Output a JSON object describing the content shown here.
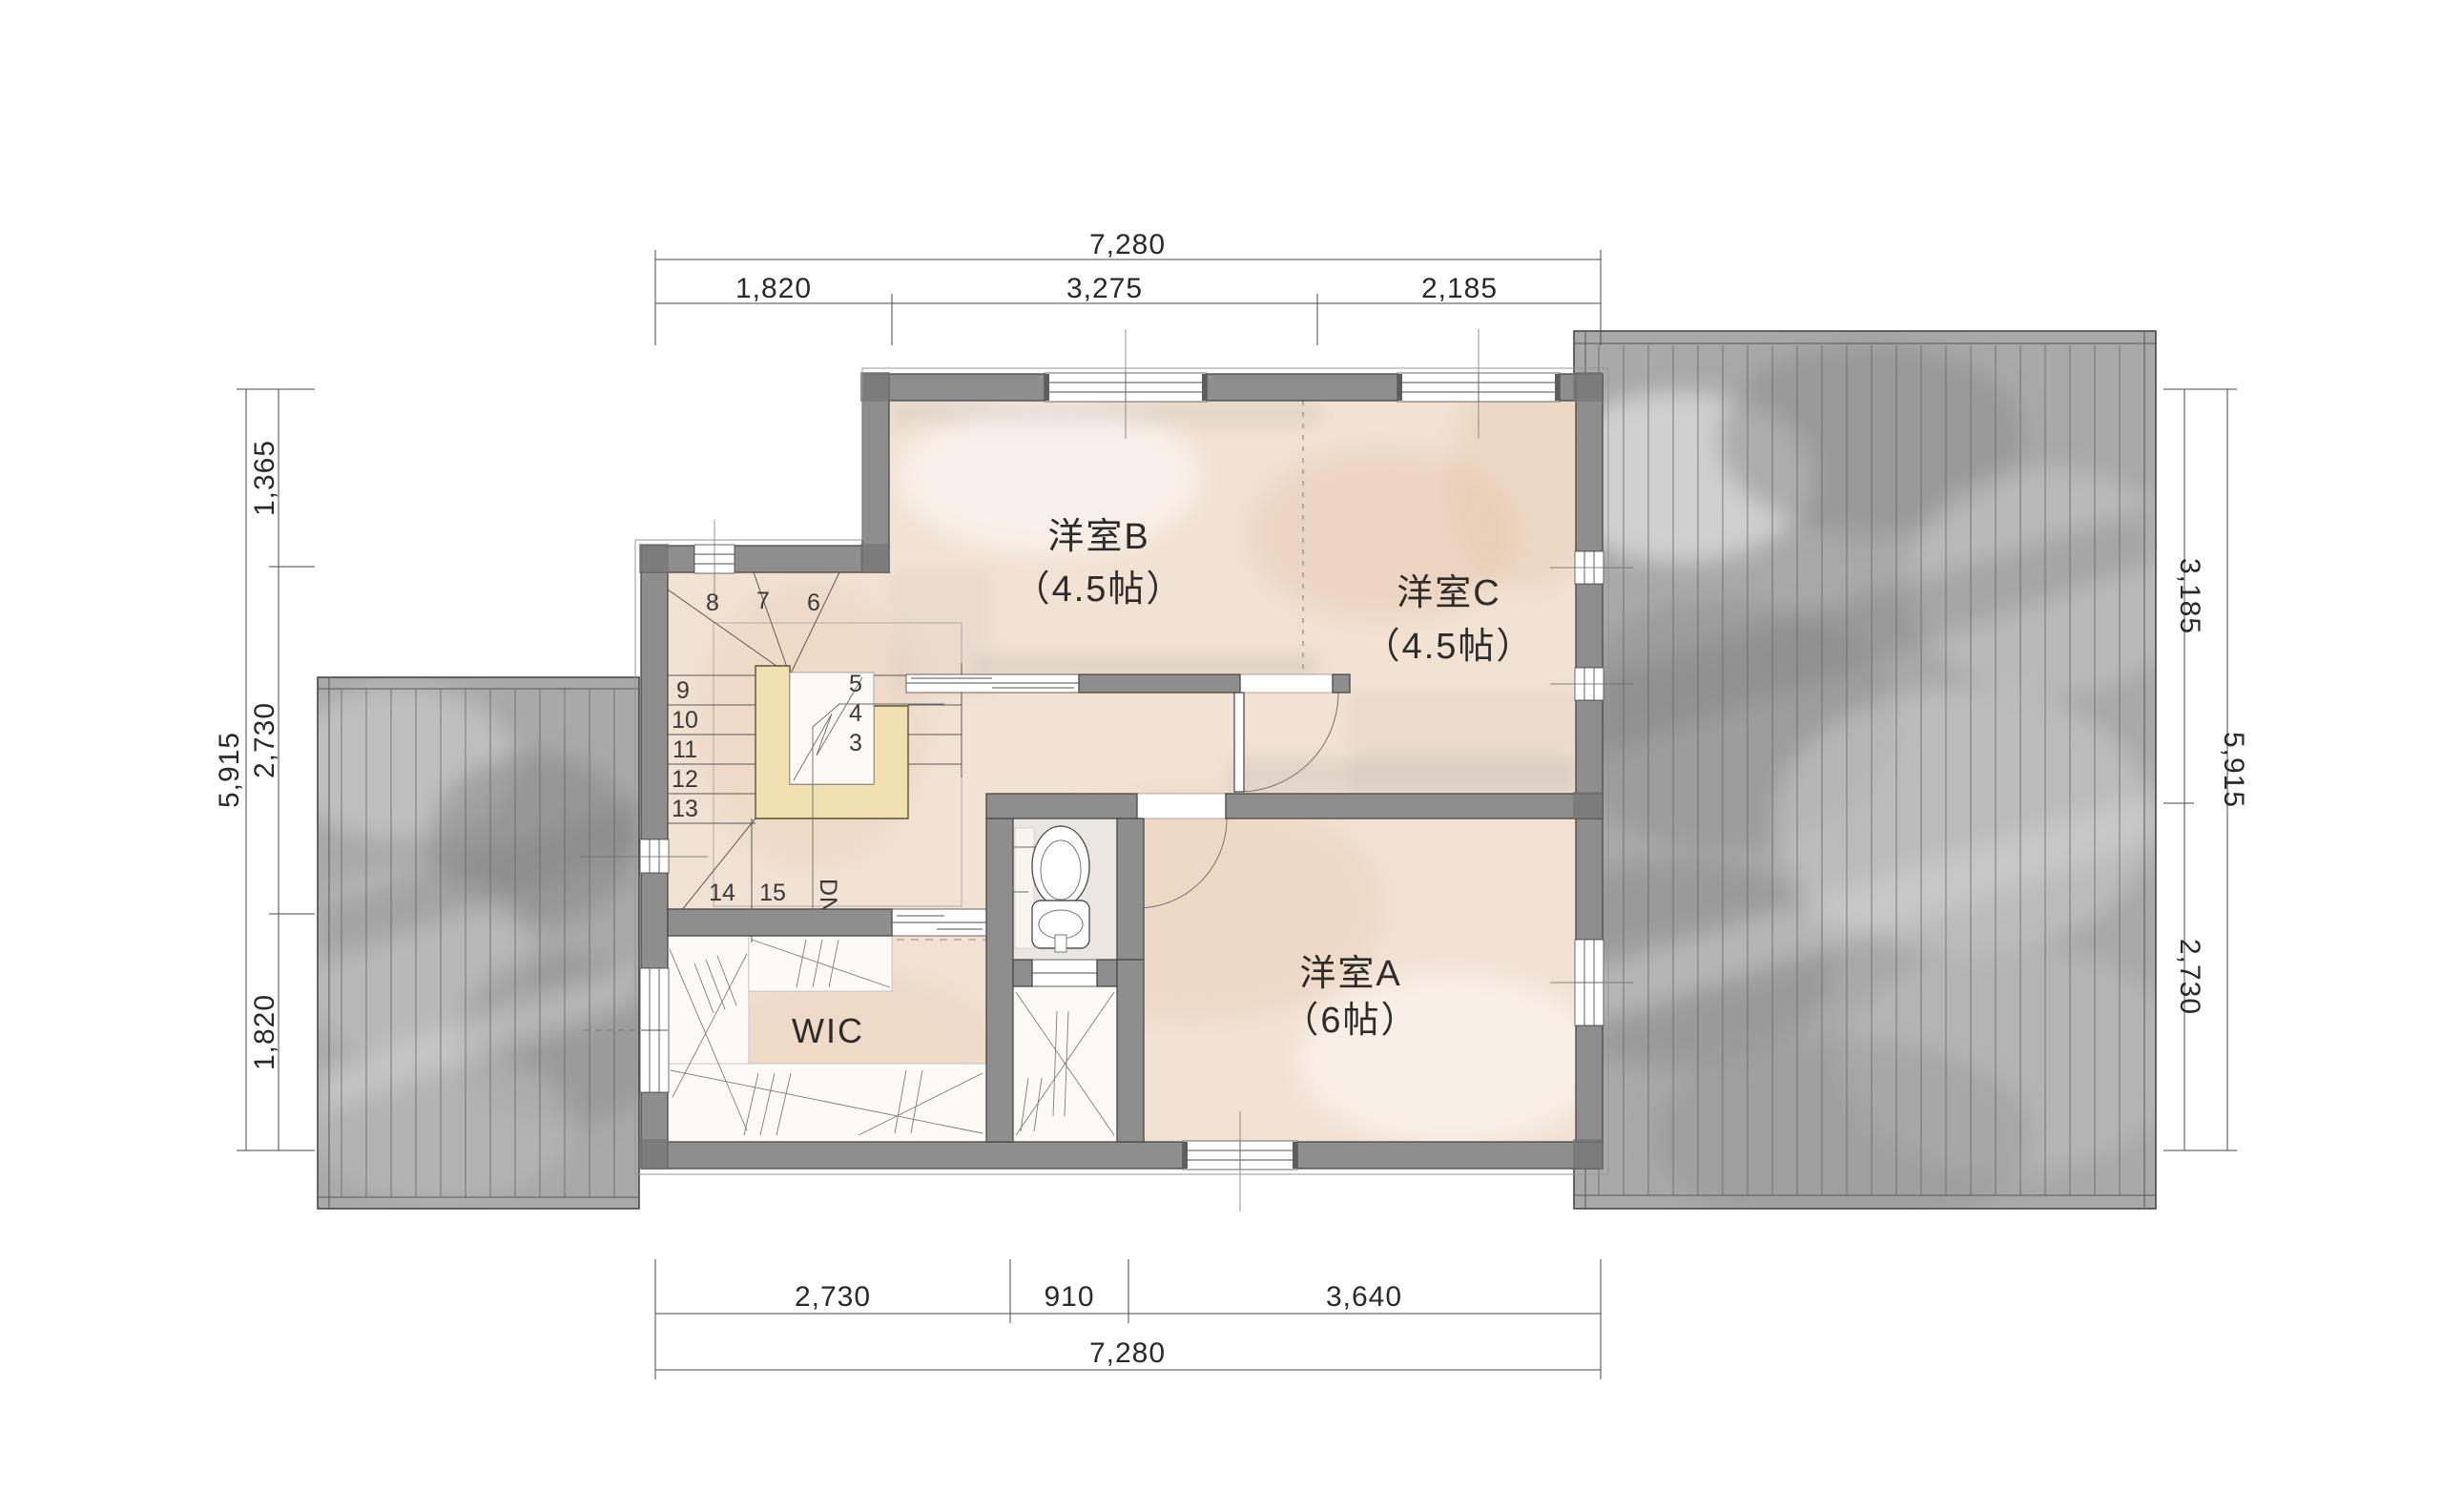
{
  "plan": {
    "rooms": {
      "room_b": {
        "name": "洋室B",
        "size": "（4.5帖）"
      },
      "room_c": {
        "name": "洋室C",
        "size": "（4.5帖）"
      },
      "room_a": {
        "name": "洋室A",
        "size": "（6帖）"
      },
      "wic": {
        "name": "WIC"
      }
    },
    "stairs": {
      "dn_label": "DN",
      "steps": [
        "3",
        "4",
        "5",
        "6",
        "7",
        "8",
        "9",
        "10",
        "11",
        "12",
        "13",
        "14",
        "15"
      ]
    },
    "dimensions": {
      "top": {
        "total": "7,280",
        "segments": [
          "1,820",
          "3,275",
          "2,185"
        ]
      },
      "bottom": {
        "total": "7,280",
        "segments": [
          "2,730",
          "910",
          "3,640"
        ]
      },
      "left": {
        "total": "5,915",
        "segments": [
          "1,365",
          "2,730",
          "1,820"
        ]
      },
      "right": {
        "total": "5,915",
        "segments": [
          "3,185",
          "2,730"
        ]
      }
    },
    "colors": {
      "wall": "#8e8e8e",
      "floor": "#f2e2d3",
      "roof": "#a9a9a9",
      "railing": "#f1e0b2"
    }
  }
}
